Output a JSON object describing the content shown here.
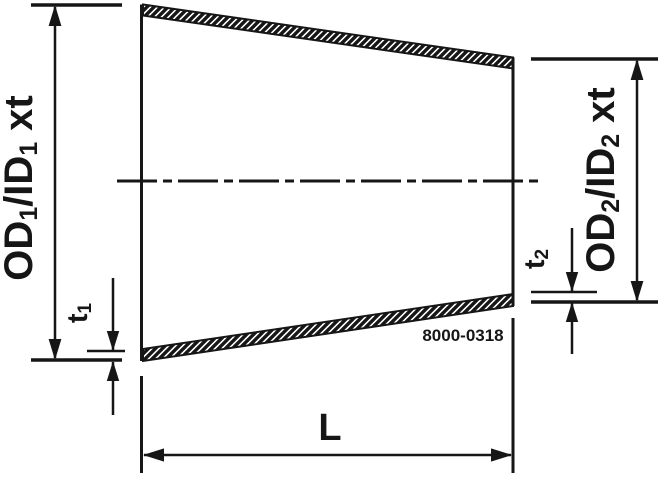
{
  "colors": {
    "line": "#161616",
    "background": "#ffffff"
  },
  "figure": {
    "od1_label": {
      "prefix": "OD",
      "sub1": "1",
      "mid": "/ID",
      "sub2": "1",
      "suffix": "xt"
    },
    "od2_label": {
      "prefix": "OD",
      "sub1": "2",
      "mid": "/ID",
      "sub2": "2",
      "suffix": "xt"
    },
    "t1_label": {
      "prefix": "t",
      "sub": "1"
    },
    "t2_label": {
      "prefix": "t",
      "sub": "2"
    },
    "length_label": "L",
    "drawing_number": "8000-0318"
  }
}
